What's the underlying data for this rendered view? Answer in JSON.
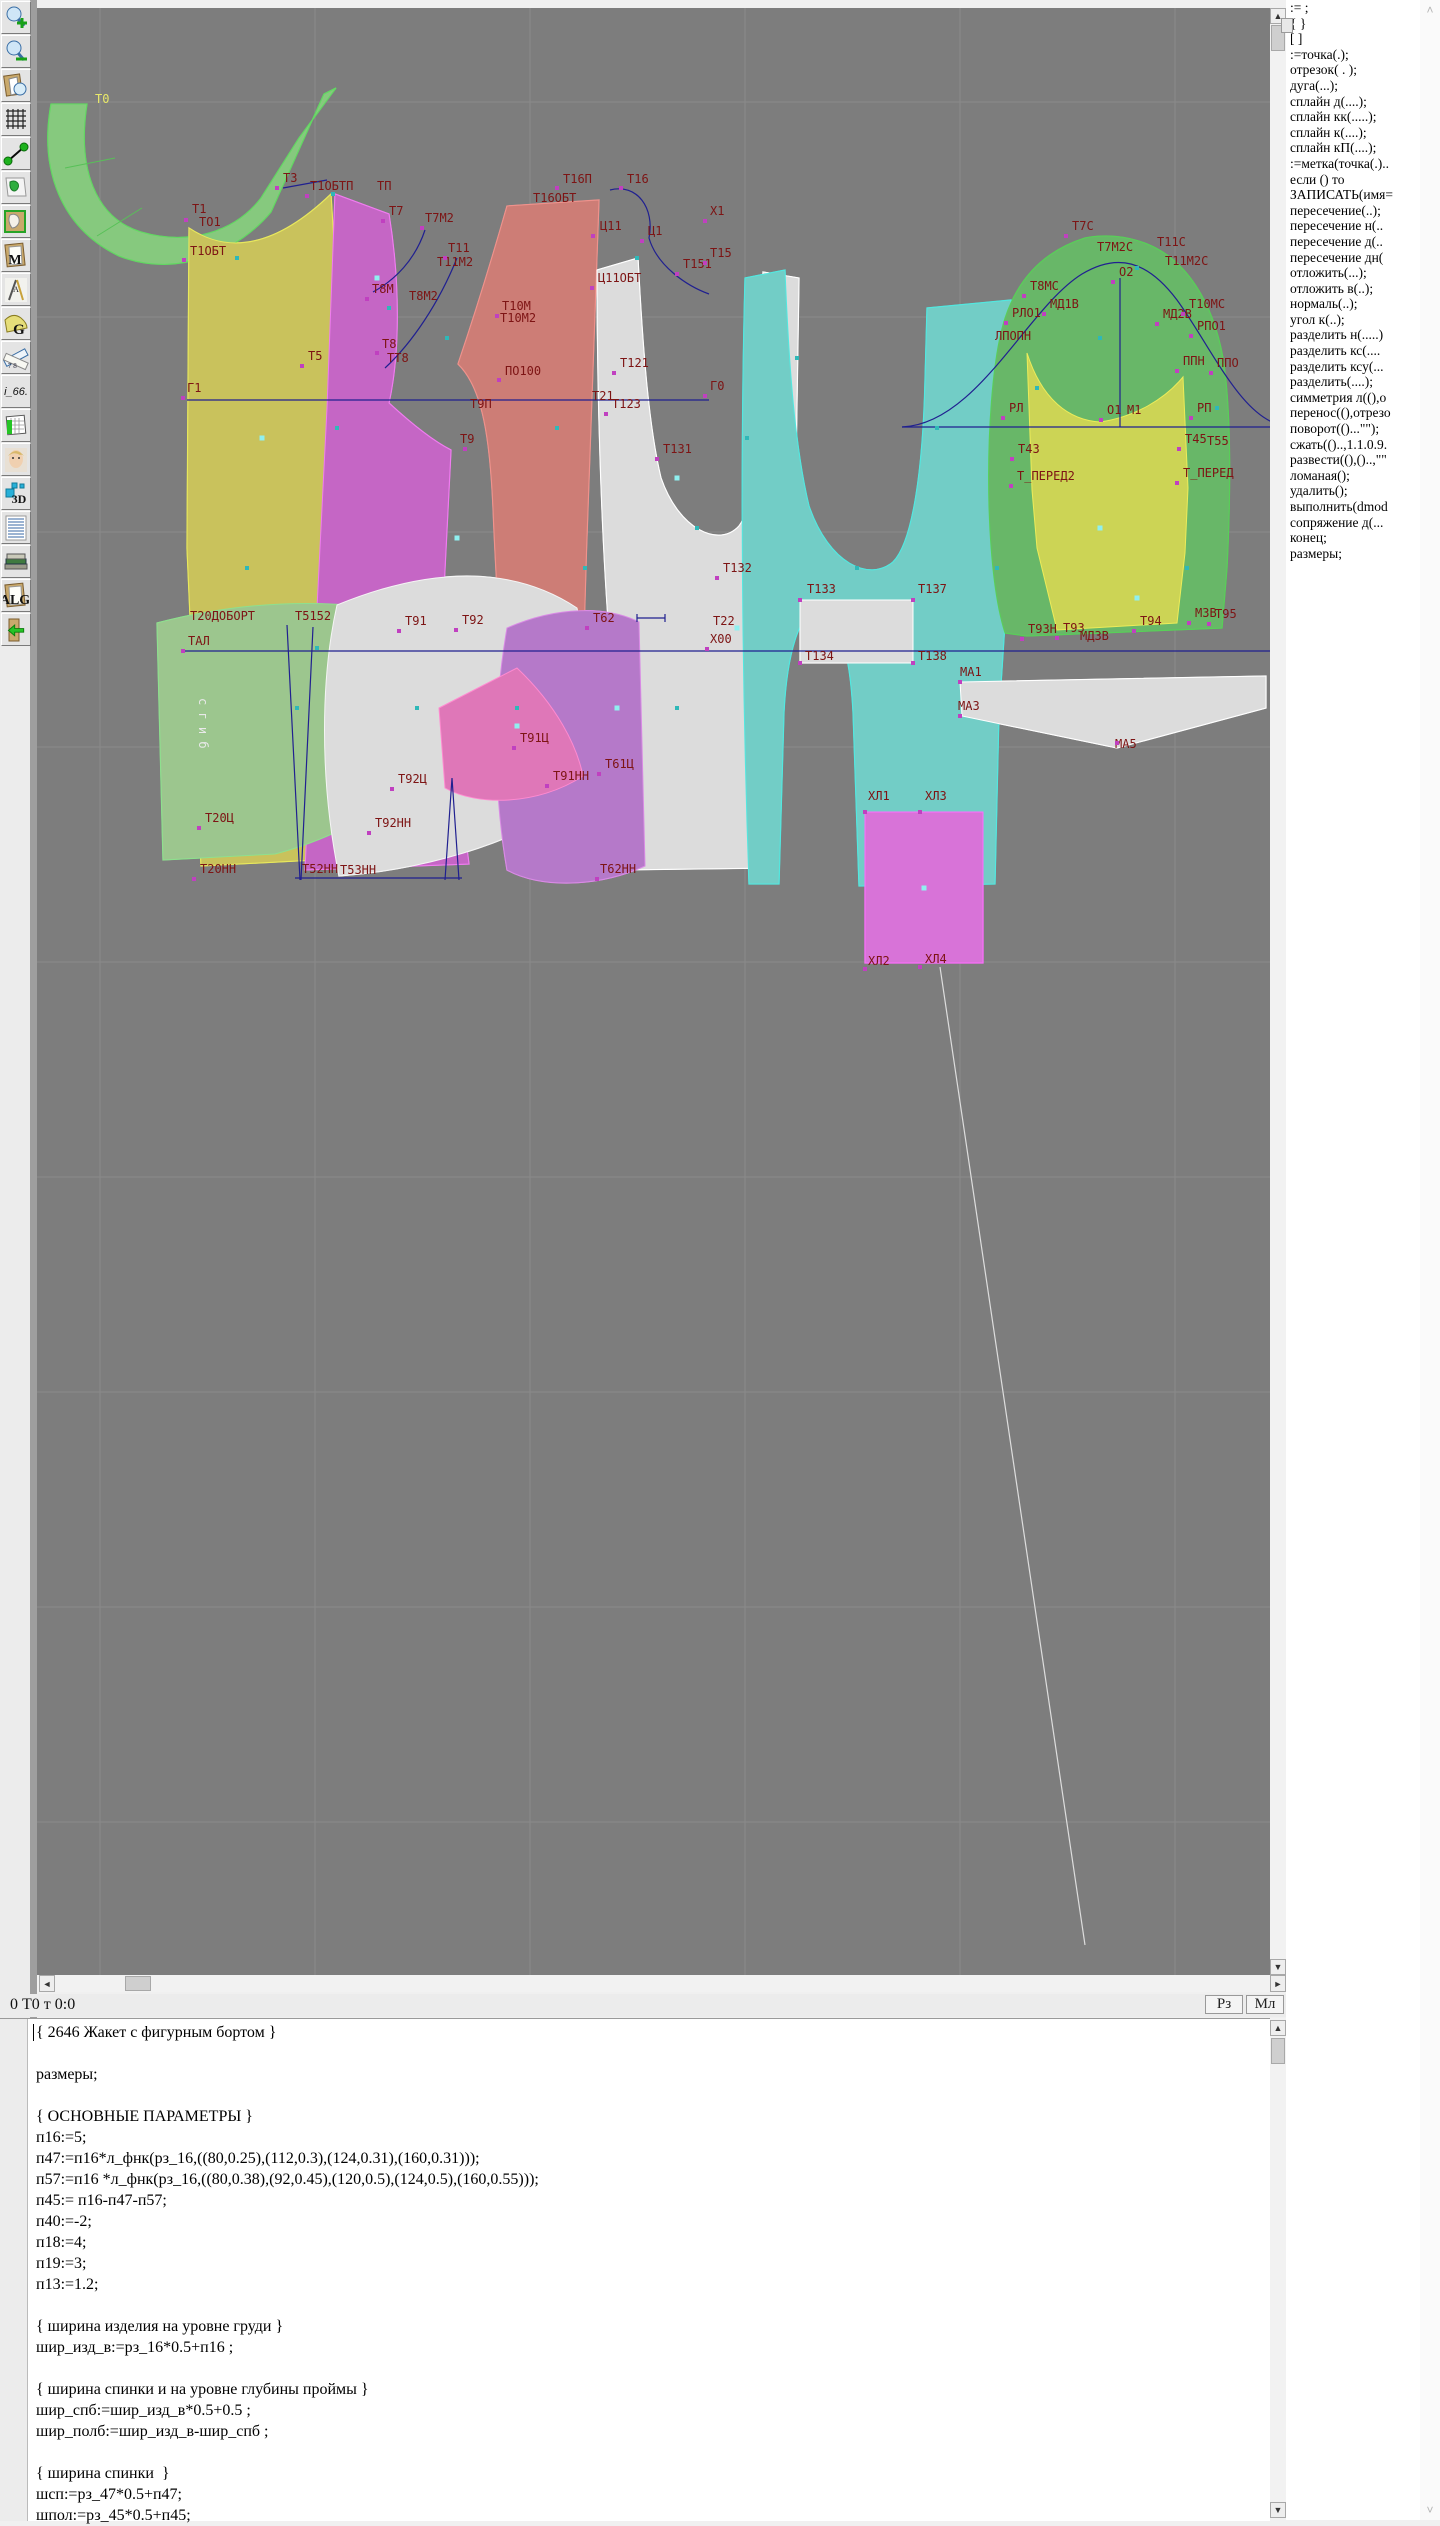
{
  "status": {
    "left": "0  Т0 т 0:0",
    "btn_rz": "Рз",
    "btn_ml": "Мл"
  },
  "toolbar": {
    "items": [
      {
        "name": "zoom-in-icon",
        "kind": "zoomin",
        "text": ""
      },
      {
        "name": "zoom-out-icon",
        "kind": "zoomout",
        "text": ""
      },
      {
        "name": "preview-piece-icon",
        "kind": "preview",
        "text": ""
      },
      {
        "name": "grid-icon",
        "kind": "grid",
        "text": ""
      },
      {
        "name": "segment-icon",
        "kind": "segment",
        "text": ""
      },
      {
        "name": "map-icon",
        "kind": "map",
        "text": ""
      },
      {
        "name": "pattern-icon",
        "kind": "pattern",
        "text": ""
      },
      {
        "name": "model-document-icon",
        "kind": "page",
        "text": "M"
      },
      {
        "name": "drafting-tools-icon",
        "kind": "draft",
        "text": "A"
      },
      {
        "name": "g-pattern-icon",
        "kind": "gpat",
        "text": "G"
      },
      {
        "name": "rulers-icon",
        "kind": "rulers",
        "text": "7 8"
      },
      {
        "name": "i66-button",
        "kind": "txt",
        "text": "i_66."
      },
      {
        "name": "size-table-icon",
        "kind": "table",
        "text": ""
      },
      {
        "name": "portrait-icon",
        "kind": "face",
        "text": ""
      },
      {
        "name": "3d-view-icon",
        "kind": "d3",
        "text": "3D"
      },
      {
        "name": "script-list-icon",
        "kind": "script",
        "text": ""
      },
      {
        "name": "books-icon",
        "kind": "books",
        "text": ""
      },
      {
        "name": "algorithm-icon",
        "kind": "page",
        "text": "ALG"
      },
      {
        "name": "import-book-icon",
        "kind": "import",
        "text": ""
      }
    ]
  },
  "sidebar": {
    "items": [
      ":= ;",
      "{  }",
      "[  ]",
      ":=точка(.);",
      "отрезок( . );",
      "дуга(...);",
      "сплайн  д(....);",
      "сплайн  кк(.....);",
      "сплайн  к(....);",
      "сплайн  кП(....);",
      ":=метка(точка(.)..",
      "если () то",
      "ЗАПИСАТЬ(имя=",
      "пересечение(..);",
      "пересечение  н(..",
      "пересечение  д(..",
      "пересечение  дн(",
      "отложить(...);",
      "отложить  в(..);",
      "нормаль(..);",
      "угол  к(..);",
      "разделить  н(.....)",
      "разделить  кс(....",
      "разделить  ксу(...",
      "разделить(....);",
      "симметрия  л((),о",
      "перенос((),отрезо",
      "поворот(()...\"\");",
      "сжать(()..,1.1.0.9.",
      "развести((),()..,\"\"",
      "ломаная();",
      "удалить();",
      "выполнить(dmod",
      "сопряжение  д(...",
      "конец;",
      "размеры;"
    ]
  },
  "editor": {
    "lines": [
      "{ 2646 Жакет с фигурным бортом }",
      "",
      "размеры;",
      "",
      "{ ОСНОВНЫЕ ПАРАМЕТРЫ }",
      "п16:=5;",
      "п47:=п16*л_фнк(рз_16,((80,0.25),(112,0.3),(124,0.31),(160,0.31)));",
      "п57:=п16 *л_фнк(рз_16,((80,0.38),(92,0.45),(120,0.5),(124,0.5),(160,0.55)));",
      "п45:= п16-п47-п57;",
      "п40:=-2;",
      "п18:=4;",
      "п19:=3;",
      "п13:=1.2;",
      "",
      "{ ширина изделия на уровне груди }",
      "шир_изд_в:=рз_16*0.5+п16 ;",
      "",
      "{ ширина спинки и на уровне глубины проймы }",
      "шир_спб:=шир_изд_в*0.5+0.5 ;",
      "шир_полб:=шир_изд_в-шир_спб ;",
      "",
      "{ ширина спинки  }",
      "шсп:=рз_47*0.5+п47;",
      "шпол:=рз_45*0.5+п45;"
    ]
  },
  "canvas": {
    "colors": {
      "label": "#7d1414",
      "label_yellow": "#e8e86a",
      "label_white": "#e9e9e9",
      "point_magenta": "#c040c0",
      "point_teal": "#2fb8b8",
      "point_cyan": "#8ff0f0",
      "construction_blue": "#202090",
      "grid": "#8a8a8a",
      "background": "#7d7d7d"
    },
    "fold_label": "с г и б",
    "labels": [
      [
        "Т0",
        58,
        95,
        "y"
      ],
      [
        "Т1",
        155,
        205
      ],
      [
        "ТО1",
        162,
        218
      ],
      [
        "Т1ОБТ",
        153,
        247
      ],
      [
        "Т3",
        246,
        174
      ],
      [
        "Т1ОБТП",
        273,
        182
      ],
      [
        "ТП",
        340,
        182
      ],
      [
        "Т7",
        352,
        207
      ],
      [
        "Т7М2",
        388,
        214
      ],
      [
        "Т11",
        411,
        244
      ],
      [
        "Т11М2",
        400,
        258
      ],
      [
        "Т8М",
        335,
        285
      ],
      [
        "Т8М2",
        372,
        292
      ],
      [
        "Т8",
        345,
        340
      ],
      [
        "ТТ8",
        350,
        354
      ],
      [
        "Т5",
        271,
        352
      ],
      [
        "Г1",
        150,
        384
      ],
      [
        "Т9П",
        433,
        400
      ],
      [
        "Т9",
        423,
        435
      ],
      [
        "Т10М",
        465,
        302
      ],
      [
        "Т10М2",
        463,
        314
      ],
      [
        "ПО100",
        468,
        367
      ],
      [
        "Т16П",
        526,
        175
      ],
      [
        "Т16",
        590,
        175
      ],
      [
        "Т16ОБТ",
        496,
        194
      ],
      [
        "Ц11",
        563,
        222
      ],
      [
        "Ц1",
        611,
        227
      ],
      [
        "Х1",
        673,
        207
      ],
      [
        "Т15",
        673,
        249
      ],
      [
        "Т151",
        646,
        260
      ],
      [
        "Ц11ОБТ",
        561,
        274
      ],
      [
        "Т121",
        583,
        359
      ],
      [
        "Т123",
        575,
        400
      ],
      [
        "Т21",
        555,
        392
      ],
      [
        "Т131",
        626,
        445
      ],
      [
        "Г0",
        673,
        382
      ],
      [
        "Т132",
        686,
        564
      ],
      [
        "Т22",
        676,
        617
      ],
      [
        "Х00",
        673,
        635
      ],
      [
        "Т133",
        770,
        585
      ],
      [
        "Т137",
        881,
        585
      ],
      [
        "Т134",
        768,
        652
      ],
      [
        "Т138",
        881,
        652
      ],
      [
        "МА1",
        923,
        668
      ],
      [
        "МА3",
        921,
        702
      ],
      [
        "МА5",
        1078,
        740
      ],
      [
        "Т62",
        556,
        614
      ],
      [
        "Т91",
        368,
        617
      ],
      [
        "Т92",
        425,
        616
      ],
      [
        "Т20ДОБОРТ",
        153,
        612
      ],
      [
        "Т5152",
        258,
        612
      ],
      [
        "ТАЛ",
        151,
        637
      ],
      [
        "Т91Ц",
        483,
        734
      ],
      [
        "Т91НН",
        516,
        772
      ],
      [
        "Т92Ц",
        361,
        775
      ],
      [
        "Т92НН",
        338,
        819
      ],
      [
        "Т20Ц",
        168,
        814
      ],
      [
        "Т20НН",
        163,
        865
      ],
      [
        "Т52НН",
        265,
        865
      ],
      [
        "Т53НН",
        303,
        866
      ],
      [
        "Т61Ц",
        568,
        760
      ],
      [
        "Т62НН",
        563,
        865
      ],
      [
        "ХЛ1",
        831,
        792
      ],
      [
        "ХЛ3",
        888,
        792
      ],
      [
        "ХЛ2",
        831,
        957
      ],
      [
        "ХЛ4",
        888,
        955
      ],
      [
        "Т7С",
        1035,
        222
      ],
      [
        "Т7М2С",
        1060,
        243
      ],
      [
        "Т11С",
        1120,
        238
      ],
      [
        "Т11М2С",
        1128,
        257
      ],
      [
        "О2",
        1082,
        268
      ],
      [
        "Т8МС",
        993,
        282
      ],
      [
        "МД1В",
        1013,
        300
      ],
      [
        "РЛО1",
        975,
        309
      ],
      [
        "ЛПОПН",
        958,
        332
      ],
      [
        "МД2В",
        1126,
        310
      ],
      [
        "Т10МС",
        1152,
        300
      ],
      [
        "РПО1",
        1160,
        322
      ],
      [
        "ППН",
        1146,
        357
      ],
      [
        "ППО",
        1180,
        359
      ],
      [
        "РЛ",
        972,
        404
      ],
      [
        "О1",
        1070,
        406
      ],
      [
        "М1",
        1090,
        406
      ],
      [
        "РП",
        1160,
        404
      ],
      [
        "Т45",
        1148,
        435
      ],
      [
        "Т55",
        1170,
        437
      ],
      [
        "Т43",
        981,
        445
      ],
      [
        "Т_ПЕРЕД2",
        980,
        472
      ],
      [
        "Т_ПЕРЕД",
        1146,
        469
      ],
      [
        "Т93Н",
        991,
        625
      ],
      [
        "Т93",
        1026,
        624
      ],
      [
        "МД3В",
        1043,
        632
      ],
      [
        "Т94",
        1103,
        617
      ],
      [
        "М3В",
        1158,
        609
      ],
      [
        "Т95",
        1178,
        610
      ]
    ],
    "points": {
      "m": [
        [
          149,
          212
        ],
        [
          147,
          252
        ],
        [
          240,
          180
        ],
        [
          270,
          188
        ],
        [
          346,
          213
        ],
        [
          385,
          220
        ],
        [
          408,
          250
        ],
        [
          330,
          291
        ],
        [
          340,
          345
        ],
        [
          265,
          358
        ],
        [
          146,
          390
        ],
        [
          428,
          441
        ],
        [
          460,
          308
        ],
        [
          462,
          372
        ],
        [
          520,
          180
        ],
        [
          584,
          180
        ],
        [
          556,
          228
        ],
        [
          605,
          233
        ],
        [
          668,
          213
        ],
        [
          668,
          255
        ],
        [
          640,
          266
        ],
        [
          555,
          280
        ],
        [
          577,
          365
        ],
        [
          569,
          406
        ],
        [
          620,
          451
        ],
        [
          668,
          388
        ],
        [
          680,
          570
        ],
        [
          670,
          641
        ],
        [
          763,
          592
        ],
        [
          876,
          592
        ],
        [
          763,
          655
        ],
        [
          876,
          655
        ],
        [
          923,
          674
        ],
        [
          923,
          708
        ],
        [
          1080,
          735
        ],
        [
          550,
          620
        ],
        [
          362,
          623
        ],
        [
          419,
          622
        ],
        [
          146,
          643
        ],
        [
          477,
          740
        ],
        [
          510,
          778
        ],
        [
          355,
          781
        ],
        [
          332,
          825
        ],
        [
          162,
          820
        ],
        [
          157,
          871
        ],
        [
          560,
          871
        ],
        [
          562,
          766
        ],
        [
          828,
          804
        ],
        [
          883,
          804
        ],
        [
          828,
          961
        ],
        [
          883,
          959
        ],
        [
          1029,
          228
        ],
        [
          1076,
          274
        ],
        [
          987,
          288
        ],
        [
          1007,
          306
        ],
        [
          969,
          315
        ],
        [
          1120,
          316
        ],
        [
          1146,
          306
        ],
        [
          1154,
          328
        ],
        [
          1140,
          363
        ],
        [
          1174,
          365
        ],
        [
          966,
          410
        ],
        [
          1064,
          412
        ],
        [
          1154,
          410
        ],
        [
          1142,
          441
        ],
        [
          975,
          451
        ],
        [
          974,
          478
        ],
        [
          1140,
          475
        ],
        [
          985,
          631
        ],
        [
          1020,
          630
        ],
        [
          1097,
          623
        ],
        [
          1152,
          615
        ],
        [
          1172,
          616
        ]
      ],
      "t": [
        [
          200,
          250
        ],
        [
          296,
          186
        ],
        [
          352,
          300
        ],
        [
          300,
          420
        ],
        [
          280,
          640
        ],
        [
          210,
          560
        ],
        [
          410,
          330
        ],
        [
          520,
          420
        ],
        [
          548,
          560
        ],
        [
          600,
          250
        ],
        [
          660,
          520
        ],
        [
          710,
          430
        ],
        [
          760,
          350
        ],
        [
          820,
          560
        ],
        [
          900,
          420
        ],
        [
          960,
          560
        ],
        [
          1000,
          380
        ],
        [
          1100,
          260
        ],
        [
          1180,
          400
        ],
        [
          1150,
          560
        ],
        [
          640,
          700
        ],
        [
          480,
          700
        ],
        [
          380,
          700
        ],
        [
          260,
          700
        ],
        [
          1063,
          330
        ]
      ],
      "c": [
        [
          225,
          430
        ],
        [
          420,
          530
        ],
        [
          640,
          470
        ],
        [
          700,
          620
        ],
        [
          887,
          880
        ],
        [
          1063,
          520
        ],
        [
          1100,
          590
        ],
        [
          580,
          700
        ],
        [
          480,
          718
        ],
        [
          340,
          270
        ]
      ]
    }
  }
}
